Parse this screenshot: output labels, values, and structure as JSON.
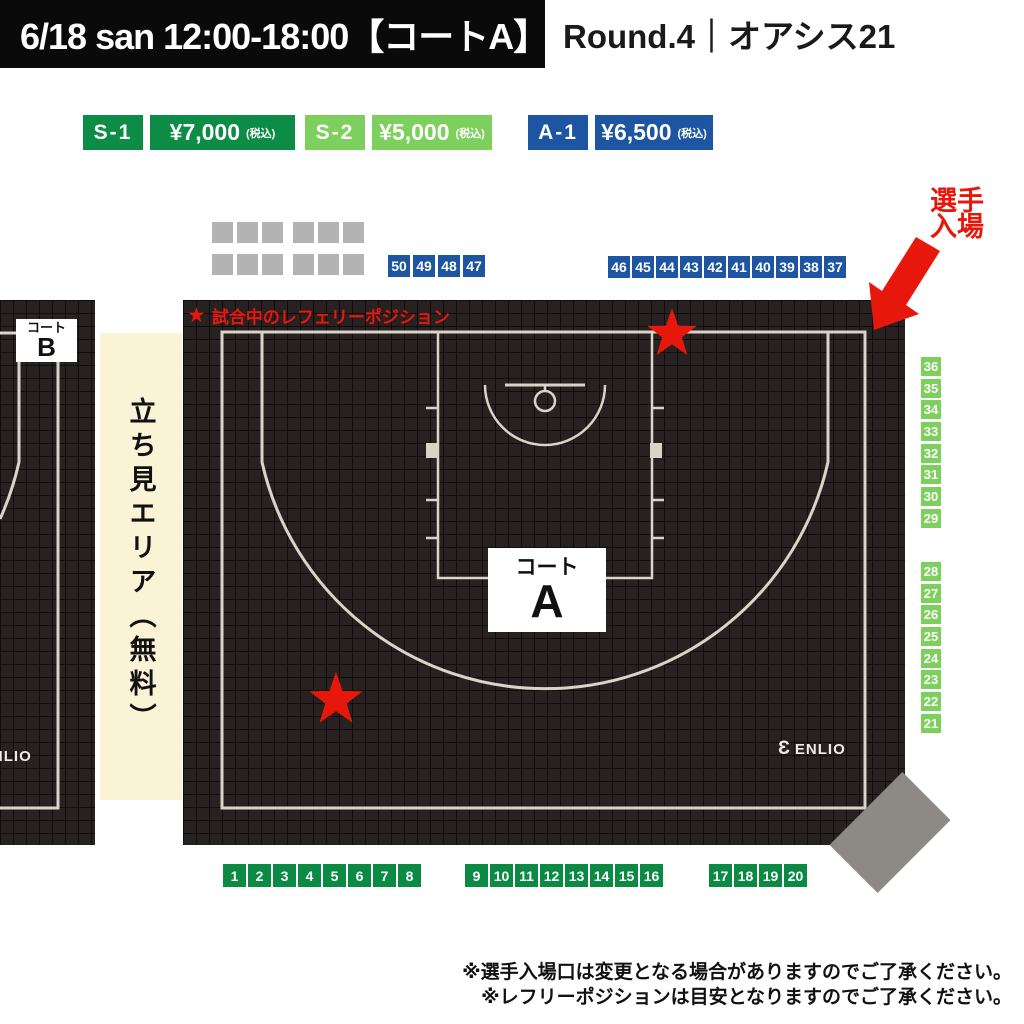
{
  "header": {
    "banner": "6/18 san 12:00-18:00【コートA】",
    "title": "Round.4｜オアシス21"
  },
  "legend": [
    {
      "label": "S-1",
      "price": "¥7,000",
      "tax_note": "(税込)",
      "color": "#0d8c45"
    },
    {
      "label": "S-2",
      "price": "¥5,000",
      "tax_note": "(税込)",
      "color": "#7ed05e"
    },
    {
      "label": "A-1",
      "price": "¥6,500",
      "tax_note": "(税込)",
      "color": "#1d55a3"
    }
  ],
  "entrance_label": {
    "line1": "選手",
    "line2": "入場",
    "color": "#e8170c"
  },
  "referee_legend": {
    "star": "★",
    "text": "試合中のレフェリーポジション",
    "color": "#e8170c"
  },
  "court_a": {
    "name_small": "コート",
    "name_letter": "A",
    "brand_mark": "Ɛ",
    "brand": "ENLIO"
  },
  "court_b": {
    "name_small": "コート",
    "name_letter": "B",
    "brand_mark": "Ɛ",
    "brand": "ENLIO"
  },
  "standing_area_label": "立ち見エリア（無料）",
  "seats": {
    "colors": {
      "blue": "#1d55a3",
      "light_green": "#7ed05e",
      "dark_green": "#0b8a43",
      "gray_block": "#b3b3b3"
    },
    "top_blue_left": [
      "50",
      "49",
      "48",
      "47"
    ],
    "top_blue_right": [
      "46",
      "45",
      "44",
      "43",
      "42",
      "41",
      "40",
      "39",
      "38",
      "37"
    ],
    "right_upper": [
      "36",
      "35",
      "34",
      "33",
      "32",
      "31",
      "30",
      "29"
    ],
    "right_lower": [
      "28",
      "27",
      "26",
      "25",
      "24",
      "23",
      "22",
      "21"
    ],
    "bottom_left": [
      "1",
      "2",
      "3",
      "4",
      "5",
      "6",
      "7",
      "8"
    ],
    "bottom_center": [
      "9",
      "10",
      "11",
      "12",
      "13",
      "14",
      "15",
      "16"
    ],
    "bottom_right": [
      "17",
      "18",
      "19",
      "20"
    ],
    "gray_blocks": {
      "groups": 4,
      "squares_per_group": 3
    }
  },
  "notes": [
    "※選手入場口は変更となる場合がありますのでご了承ください。",
    "※レフリーポジションは目安となりますのでご了承ください。"
  ],
  "accent_colors": {
    "red": "#e8170c",
    "court_line": "#d8d4c8",
    "court_bg": "#272121",
    "standing_bg": "#faf3d5",
    "diamond_gray": "#8d8a85"
  }
}
